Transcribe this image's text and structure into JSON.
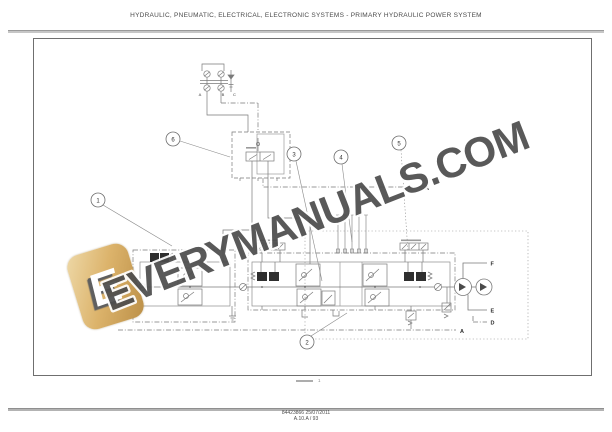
{
  "page": {
    "header_title": "HYDRAULIC, PNEUMATIC, ELECTRICAL, ELECTRONIC SYSTEMS - PRIMARY HYDRAULIC POWER SYSTEM",
    "footer_ref": "84423866 25/07/2011",
    "footer_page": "A.10.A / 93",
    "sheet_note": "1"
  },
  "watermark": {
    "text": "EVERYMANUALS.COM",
    "logo_letter": "E",
    "text_color": "#4d4d4d",
    "logo_gradient_top": "#ecd39c",
    "logo_gradient_bottom": "#bb8f47"
  },
  "diagram": {
    "callouts": [
      "1",
      "2",
      "3",
      "4",
      "5",
      "6"
    ],
    "ports": {
      "a": "A",
      "b": "B",
      "c": "C"
    },
    "lines": {
      "a_mid": "A",
      "a_bottom": "A",
      "d": "D",
      "e": "E",
      "f": "F"
    }
  }
}
